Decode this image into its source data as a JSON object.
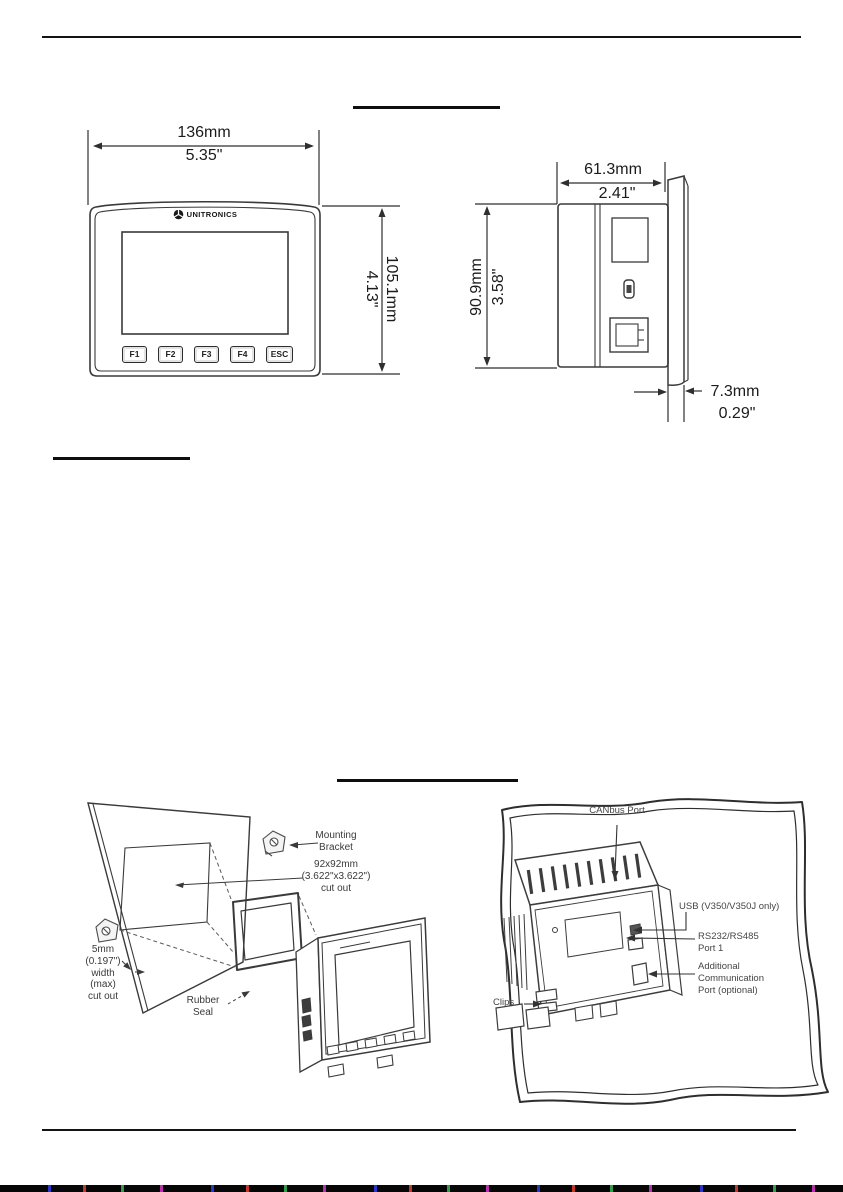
{
  "front_view": {
    "width_mm": "136mm",
    "width_in": "5.35\"",
    "height_mm": "105.1mm",
    "height_in": "4.13\"",
    "brand": "UNITRONICS",
    "buttons": [
      "F1",
      "F2",
      "F3",
      "F4",
      "ESC"
    ]
  },
  "side_view": {
    "depth_mm": "61.3mm",
    "depth_in": "2.41\"",
    "height_mm": "90.9mm",
    "height_in": "3.58\"",
    "panel_mm": "7.3mm",
    "panel_in": "0.29\""
  },
  "mounting": {
    "bracket": "Mounting\nBracket",
    "cutout": "92x92mm\n(3.622\"x3.622\")\ncut out",
    "panel_width": "5mm\n(0.197\")\nwidth\n(max)\ncut out",
    "seal": "Rubber\nSeal"
  },
  "rear_view": {
    "canbus": "CANbus Port",
    "usb": "USB (V350/V350J only)",
    "rs232": "RS232/RS485\nPort 1",
    "additional": "Additional\nCommunication\nPort (optional)",
    "clips": "Clips"
  }
}
